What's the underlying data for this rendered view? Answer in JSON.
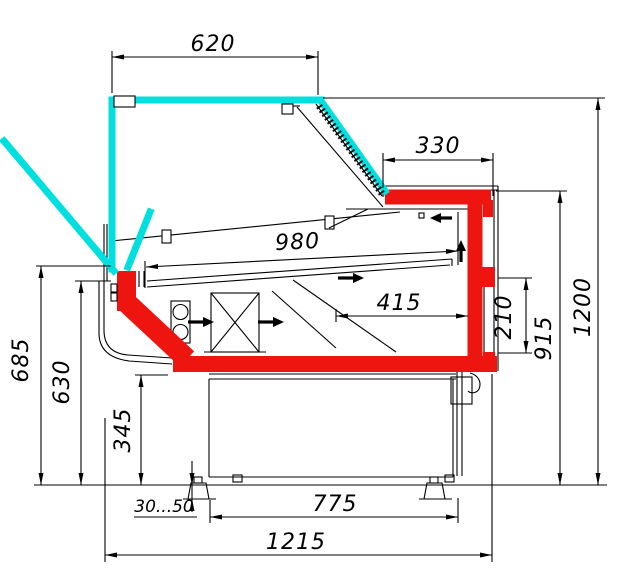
{
  "drawing": {
    "type": "technical-cross-section",
    "subject": "refrigerated serve-over display counter, side section with dimensions",
    "units": "mm",
    "dims": {
      "d620": "620",
      "d330": "330",
      "d980": "980",
      "d415": "415",
      "d210": "210",
      "d915": "915",
      "d1200": "1200",
      "d685": "685",
      "d630": "630",
      "d345": "345",
      "d3050": "30...50",
      "d775": "775",
      "d1215": "1215"
    },
    "colors": {
      "glass": "#00dfe0",
      "insulation": "#ee1410",
      "line": "#000000",
      "bg": "#ffffff"
    }
  }
}
